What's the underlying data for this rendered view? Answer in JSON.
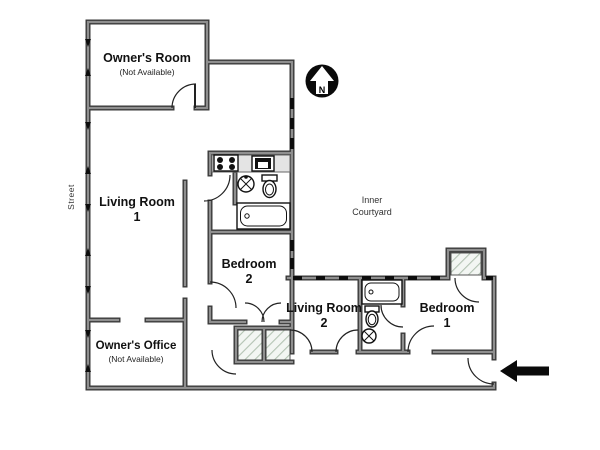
{
  "floorplan": {
    "labels": {
      "street": "Street",
      "courtyard_line1": "Inner",
      "courtyard_line2": "Courtyard",
      "compass_n": "N"
    },
    "rooms": {
      "owners_room": {
        "name": "Owner's Room",
        "note": "(Not Available)"
      },
      "living_room_1": {
        "name": "Living Room",
        "number": "1"
      },
      "bedroom_2": {
        "name": "Bedroom",
        "number": "2"
      },
      "living_room_2": {
        "name": "Living Room",
        "number": "2"
      },
      "bedroom_1": {
        "name": "Bedroom",
        "number": "1"
      },
      "owners_office": {
        "name": "Owner's Office",
        "note": "(Not Available)"
      }
    },
    "icons": {
      "compass": "north-compass-icon",
      "entrance": "entrance-arrow-icon",
      "fixtures": [
        "stove-icon",
        "kitchen-sink-icon",
        "washbasin-icon",
        "toilet-icon",
        "bathtub-icon"
      ],
      "hatched_areas": [
        "closet",
        "closet",
        "bay-window"
      ]
    },
    "colors": {
      "wall_edge": "#3a3a3a",
      "wall_core": "#8f8f8f",
      "counter": "#e4e4e4",
      "hatch_line": "#b3c3b3",
      "hatch_bg": "#f3f6f3",
      "ink": "#111111",
      "background": "#ffffff"
    }
  }
}
